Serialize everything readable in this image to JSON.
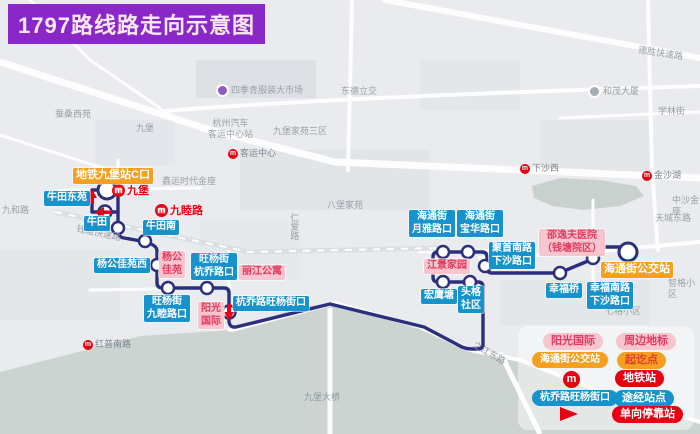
{
  "title": "1797路线路走向示意图",
  "icons": {
    "metro_glyph": "m"
  },
  "stops": [
    "地铁九堡站C口",
    "牛田东苑",
    "牛田",
    "牛田南",
    "杨公佳苑西",
    "旺杨街\n九睦路口",
    "旺杨街\n杭乔路口",
    "杭乔路旺杨街口",
    "宏鹰塘",
    "头格\n社区",
    "海通街\n月雅路口",
    "海通街\n宝华路口",
    "聚首南路\n下沙路口",
    "幸福桥",
    "幸福南路\n下沙路口",
    "海通街公交站"
  ],
  "landmarks": [
    "杨公\n佳苑",
    "丽江公寓",
    "阳光\n国际",
    "江景家园",
    "邵逸夫医院\n（钱塘院区）"
  ],
  "metro_on_route": [
    "九堡",
    "九睦路"
  ],
  "map_labels": [
    "蚕桑西苑",
    "九堡",
    "四季青服装大市场",
    "东德立交",
    "杭州汽车\n客运中心站",
    "九堡家苑三区",
    "客运中心",
    "鑫运时代金座",
    "九和路",
    "钱塘快速路",
    "八堡家苑",
    "仁爱路",
    "德胜快速路",
    "和茂大厦",
    "学林街",
    "下沙西",
    "金沙湖",
    "天城东路",
    "中沙金座",
    "七格小区",
    "智格小区",
    "红普南路",
    "九堡大桥",
    "之江东路"
  ],
  "legend": {
    "rows": [
      {
        "sample": "阳光国际",
        "desc": "周边地标"
      },
      {
        "sample": "海通街公交站",
        "desc": "起讫点"
      },
      {
        "sample": "",
        "desc": "地铁站"
      },
      {
        "sample": "杭乔路旺杨街口",
        "desc": "途经站点"
      },
      {
        "sample": "",
        "desc": "单向停靠站"
      }
    ]
  },
  "colors": {
    "route": "#2a2f7e",
    "stop_blue": "#1693cc",
    "terminal_orange": "#f5a020",
    "landmark_pink": "#f7c5cd",
    "metro_red": "#e60012",
    "title_purple": "#8a27c8",
    "water": "#ccd4d2"
  }
}
